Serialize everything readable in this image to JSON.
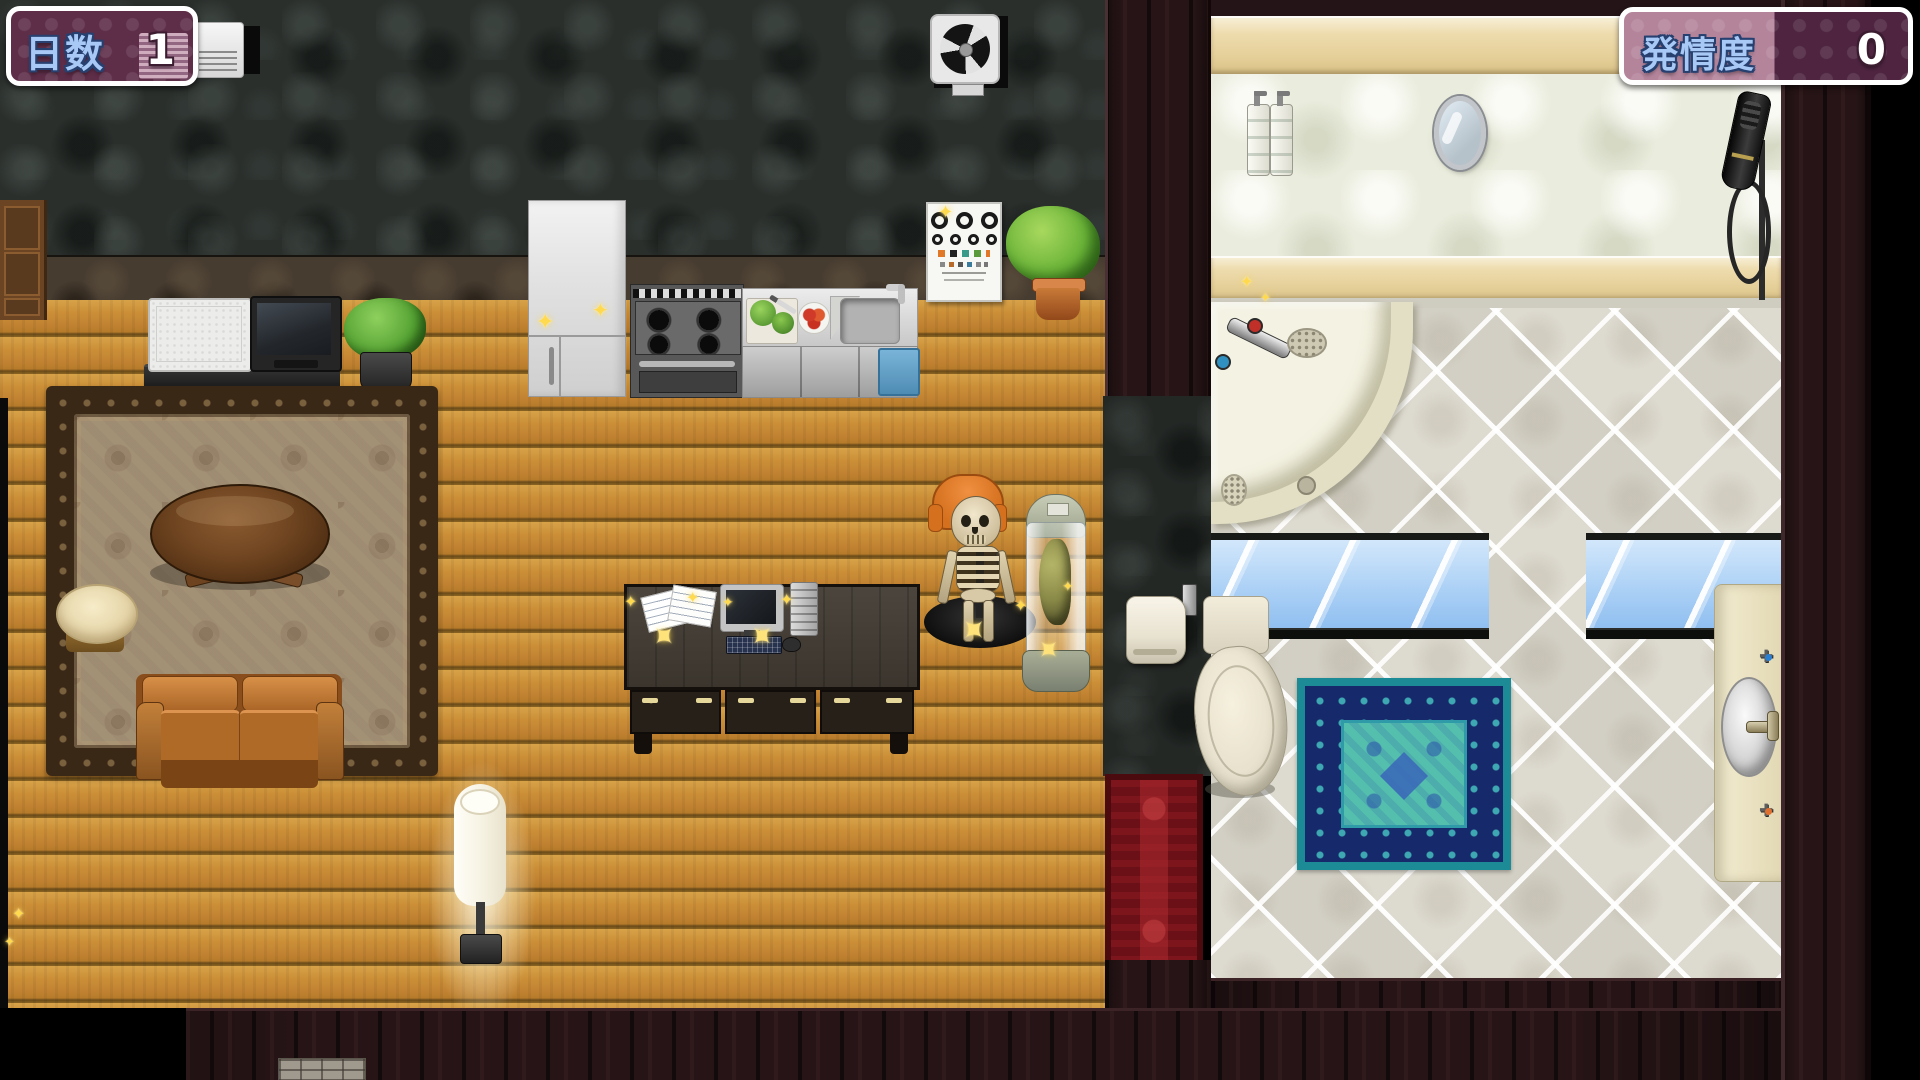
{
  "hud": {
    "days": {
      "label": "日数",
      "value": "1"
    },
    "arousal": {
      "label": "発情度",
      "value": "0"
    }
  },
  "icons": {
    "sparkle": "✦",
    "valve_cross": "✚"
  },
  "palette": {
    "hud_background": "#5e2d48",
    "hud_gauge_light": "#b4849b",
    "hud_border": "#ffffff",
    "hud_label_blue": "#a8c8f6",
    "hud_value_white": "#ffffff",
    "wood_floor": "#c68c36",
    "charcoal_wall": "#2a2f2c",
    "stone_baseboard": "#473c30",
    "maroon_wall": "#261416",
    "bath_marble_wall": "#eaecdd",
    "bath_beige_band": "#e7d4a4",
    "bath_tile_floor": "#e8e5db",
    "window_glass": "#a9cff5",
    "bath_rug_teal": "#55bfae",
    "bath_rug_navy": "#15296b",
    "bath_rug_border": "#1d8b95",
    "doorway_rug_red": "#6a1016",
    "sparkle_gold": "#ffd94e"
  },
  "scene": {
    "left_room_objects": [
      "wall-air-conditioner",
      "ventilation-fan",
      "eye-test-chart",
      "wooden-cabinet",
      "refrigerator",
      "gas-stove",
      "kitchen-counter",
      "kitchen-sink",
      "cutting-board",
      "tomato-plate",
      "white-appliance",
      "television",
      "tv-stand",
      "potted-plant-small",
      "potted-plant-large",
      "living-rug",
      "coffee-table",
      "stool",
      "sofa",
      "floor-lamp",
      "work-desk",
      "computer-monitor",
      "keyboard",
      "pc-tower",
      "mouse",
      "papers",
      "skeleton-display",
      "player-character",
      "specimen-capsule"
    ],
    "divider_objects": [
      "toilet-paper-holder",
      "doorway-rug"
    ],
    "bathroom_objects": [
      "shampoo-bottles",
      "wall-mirror",
      "hand-shower",
      "corner-bathtub",
      "window-left",
      "window-right",
      "toilet",
      "bath-rug",
      "sink-vanity"
    ],
    "bottom_objects": [
      "stone-doormat"
    ]
  }
}
